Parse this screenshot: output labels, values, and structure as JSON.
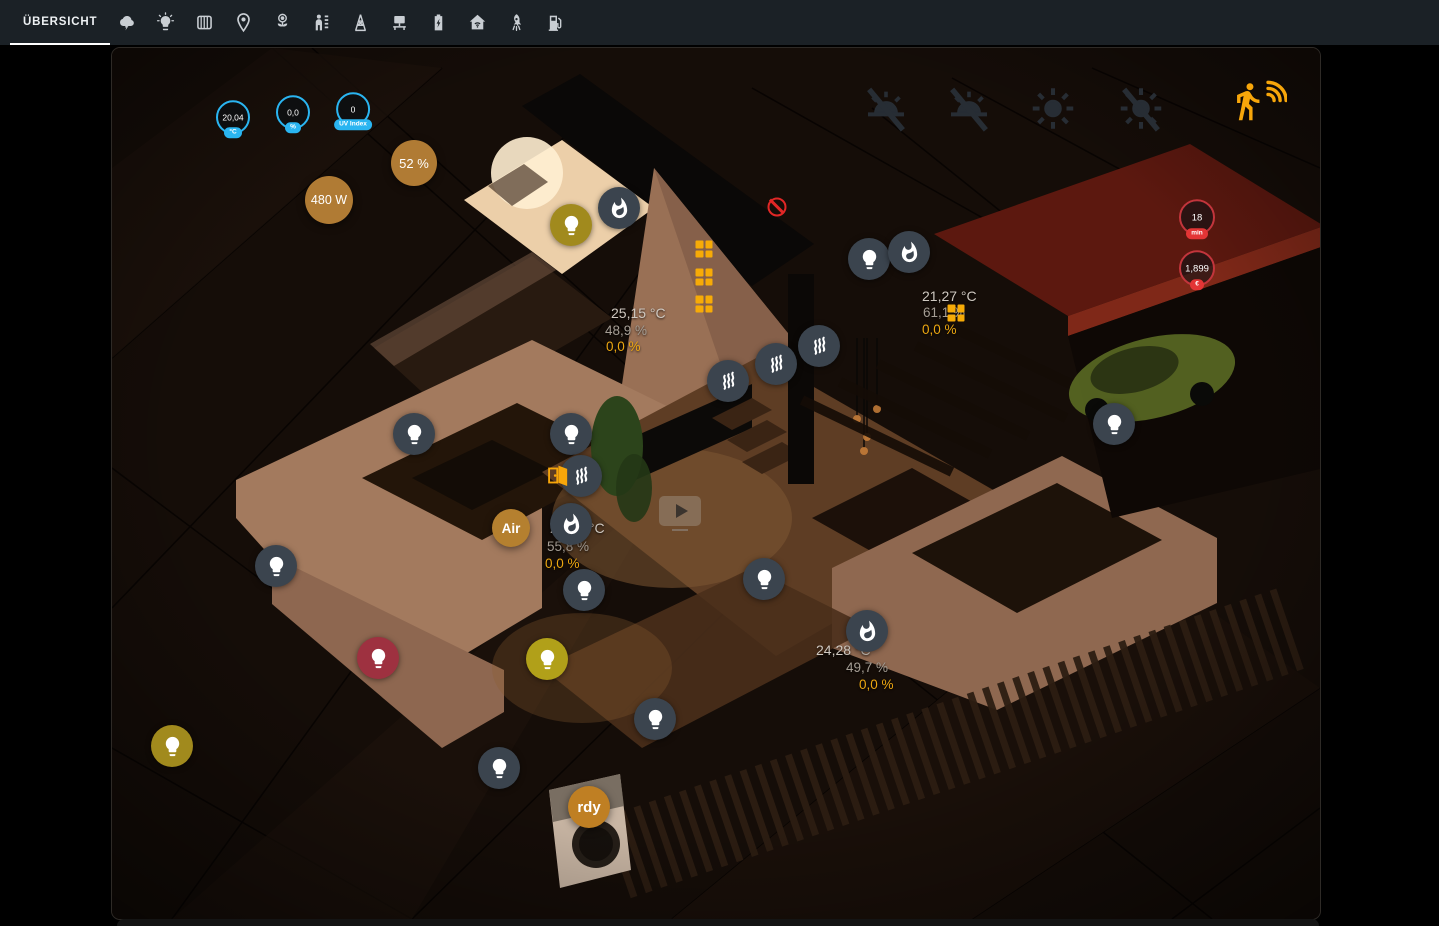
{
  "nav": {
    "active_tab": "ÜBERSICHT",
    "icons": [
      "weather",
      "lights",
      "heating",
      "irrigation",
      "plants",
      "presence",
      "power-grid",
      "workspace",
      "battery",
      "home-network",
      "rocket",
      "ev-charger"
    ]
  },
  "scene": {
    "sensors": {
      "outdoor_temperature": {
        "value": "20,04",
        "unit": "°C"
      },
      "precipitation": {
        "value": "0,0",
        "unit": "%"
      },
      "uv": {
        "value": "0",
        "unit": "UV Index"
      },
      "solar": {
        "value": "52 %"
      },
      "power": {
        "value": "480 W"
      },
      "car_charge_time": {
        "value": "18",
        "unit": "min"
      },
      "car_price": {
        "value": "1,899",
        "unit": "€"
      }
    },
    "climate": [
      {
        "temperature": "25,15 °C",
        "humidity": "48,9 %",
        "percent": "0,0 %"
      },
      {
        "temperature": "21,27 °C",
        "humidity": "61,1 %",
        "percent": "0,0 %"
      },
      {
        "temperature": "23,73 °C",
        "humidity": "55,8 %",
        "percent": "0,0 %"
      },
      {
        "temperature": "24,28 °C",
        "humidity": "49,7 %",
        "percent": "0,0 %"
      }
    ],
    "labels": {
      "air": "Air",
      "washer": "rdy"
    }
  },
  "colors": {
    "accent_cyan": "#2ab5f1",
    "accent_orange": "#f7a60a",
    "badge_orange": "#b07b34",
    "alert_red": "#e33535",
    "light_on_yellow": "#b1a019",
    "light_on_olive": "#a18a1d",
    "light_on_red": "#9e3140",
    "icon_circle_dark": "#3b444e"
  }
}
